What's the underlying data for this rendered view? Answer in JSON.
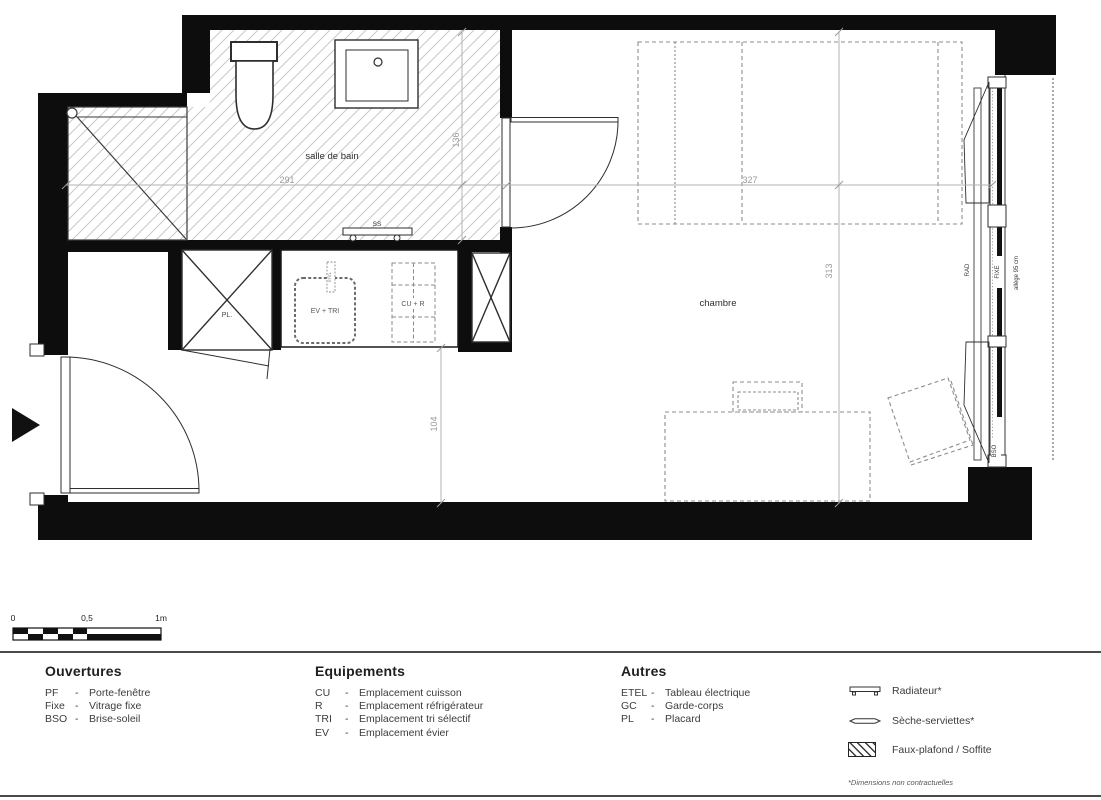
{
  "plan": {
    "rooms": {
      "bathroom": "salle de bain",
      "bedroom": "chambre"
    },
    "dimensions": {
      "bathroom_width": "291",
      "bathroom_height": "136",
      "bedroom_width": "327",
      "bedroom_height": "313",
      "corridor_width": "104"
    },
    "labels": {
      "towel_dryer": "SS",
      "closet": "PL.",
      "sink_tri": "EV + TRI",
      "cooking_fridge": "CU + R",
      "electrical_panel": "ETEL",
      "radiator": "RAD",
      "fixed_glazing": "FIXE",
      "window_sill": "allège 95 cm",
      "solar_shading": "BSO"
    }
  },
  "scale_bar": {
    "start": "0",
    "middle": "0,5",
    "end": "1m"
  },
  "legend": {
    "separator": "-",
    "ouvertures": {
      "title": "Ouvertures",
      "items": [
        {
          "abbr": "PF",
          "label": "Porte-fenêtre"
        },
        {
          "abbr": "Fixe",
          "label": "Vitrage fixe"
        },
        {
          "abbr": "BSO",
          "label": "Brise-soleil"
        }
      ]
    },
    "equipements": {
      "title": "Equipements",
      "items": [
        {
          "abbr": "CU",
          "label": "Emplacement cuisson"
        },
        {
          "abbr": "R",
          "label": "Emplacement réfrigérateur"
        },
        {
          "abbr": "TRI",
          "label": "Emplacement tri sélectif"
        },
        {
          "abbr": "EV",
          "label": "Emplacement évier"
        }
      ]
    },
    "autres": {
      "title": "Autres",
      "items": [
        {
          "abbr": "ETEL",
          "label": "Tableau électrique"
        },
        {
          "abbr": "GC",
          "label": "Garde-corps"
        },
        {
          "abbr": "PL",
          "label": "Placard"
        }
      ]
    },
    "symbols": [
      {
        "label": "Radiateur*"
      },
      {
        "label": "Sèche-serviettes*"
      },
      {
        "label": "Faux-plafond / Soffite"
      }
    ],
    "footnote": "*Dimensions non contractuelles"
  }
}
